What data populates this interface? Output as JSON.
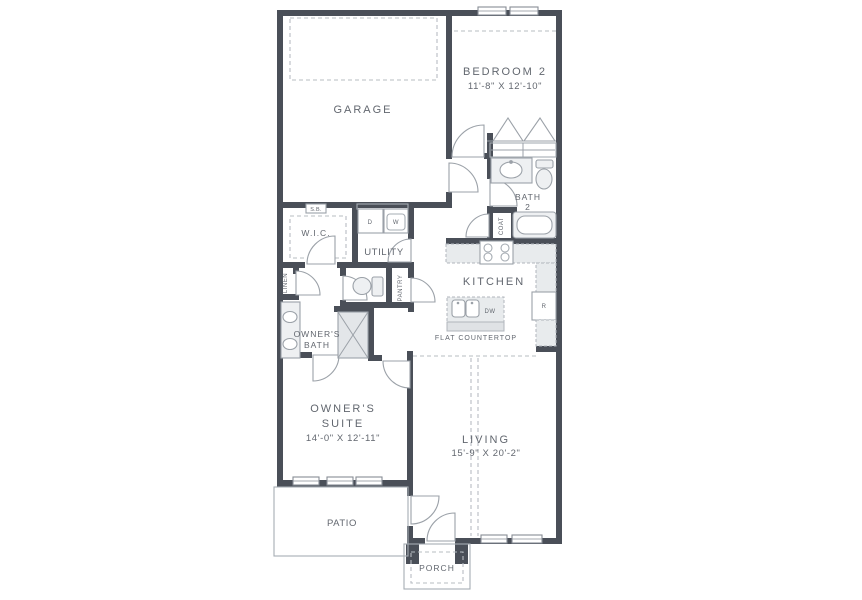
{
  "plan_title": "Floor Plan",
  "colors": {
    "wall": "#4a4f58",
    "line": "#9ba1a8",
    "fixture_fill": "#eef0f2",
    "counter_fill": "#e8ebed",
    "dash": "#b7bcc2",
    "text": "#62676f",
    "background": "#ffffff"
  },
  "rooms": {
    "garage": {
      "label": "GARAGE"
    },
    "bedroom2": {
      "label": "BEDROOM 2",
      "dims": "11'-8\" X 12'-10\""
    },
    "bath2": {
      "label_line1": "BATH",
      "label_line2": "2"
    },
    "wic": {
      "label": "W.I.C."
    },
    "sb": {
      "label": "S.B."
    },
    "utility": {
      "label": "UTILITY"
    },
    "linen": {
      "label": "LINEN"
    },
    "pantry": {
      "label": "PANTRY"
    },
    "coat": {
      "label": "COAT"
    },
    "kitchen": {
      "label": "KITCHEN",
      "counter_note": "FLAT COUNTERTOP"
    },
    "owners_bath": {
      "label_line1": "OWNER'S",
      "label_line2": "BATH"
    },
    "owners_suite": {
      "label_line1": "OWNER'S",
      "label_line2": "SUITE",
      "dims": "14'-0\" X 12'-11\""
    },
    "living": {
      "label": "LIVING",
      "dims": "15'-9\" X 20'-2\""
    },
    "patio": {
      "label": "PATIO"
    },
    "porch": {
      "label": "PORCH"
    }
  },
  "appliances": {
    "dryer": "D",
    "washer": "W",
    "dishwasher": "DW",
    "refrigerator": "R"
  }
}
